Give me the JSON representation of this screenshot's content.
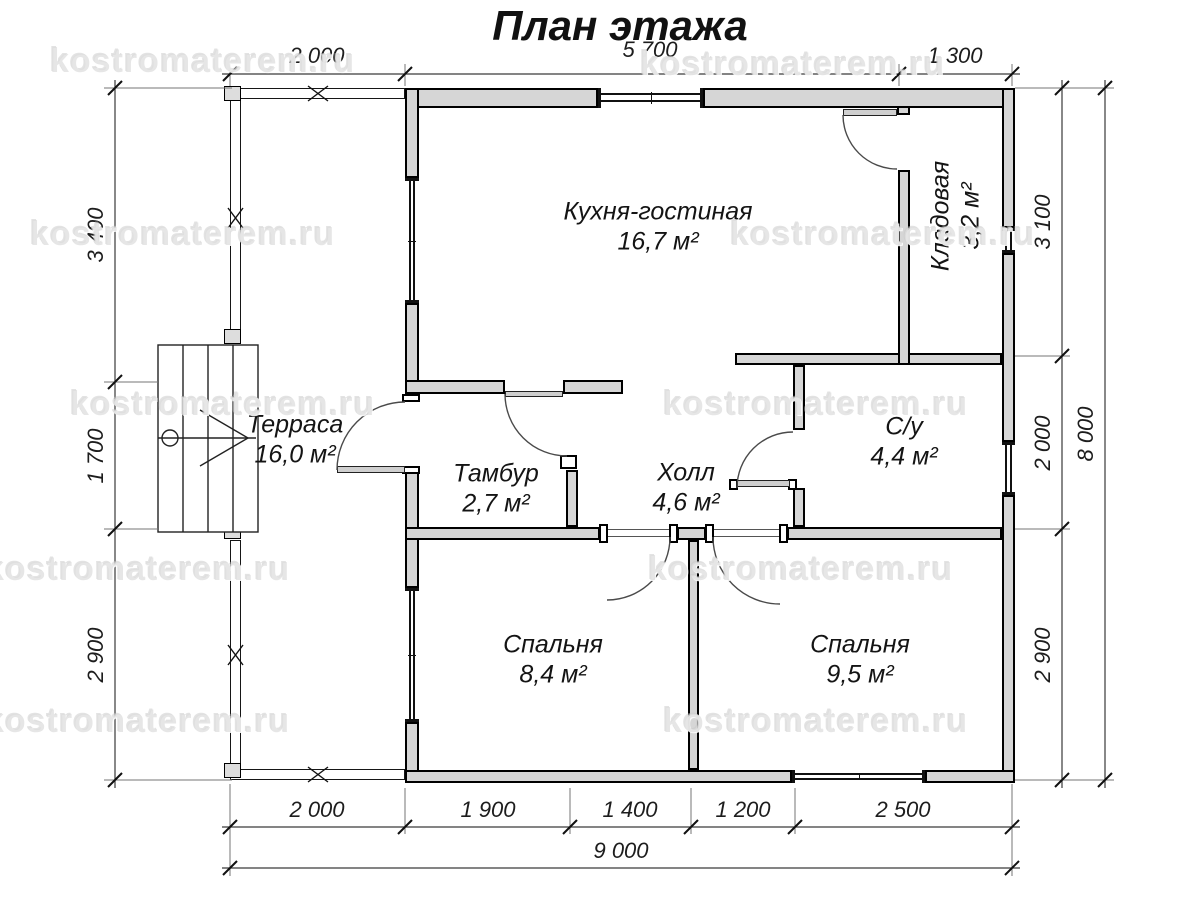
{
  "title": "План этажа",
  "watermark": "kostromaterem.ru",
  "rooms": {
    "kitchen": {
      "name": "Кухня-гостиная",
      "area": "16,7 м²"
    },
    "pantry": {
      "name": "Кладовая",
      "area": "3,2 м²"
    },
    "terrace": {
      "name": "Терраса",
      "area": "16,0 м²"
    },
    "vestibule": {
      "name": "Тамбур",
      "area": "2,7 м²"
    },
    "hall": {
      "name": "Холл",
      "area": "4,6 м²"
    },
    "bathroom": {
      "name": "С/у",
      "area": "4,4 м²"
    },
    "bedroom1": {
      "name": "Спальня",
      "area": "8,4 м²"
    },
    "bedroom2": {
      "name": "Спальня",
      "area": "9,5 м²"
    }
  },
  "dimensions": {
    "top": [
      "2 000",
      "5 700",
      "1 300"
    ],
    "left": [
      "3 400",
      "1 700",
      "2 900"
    ],
    "right": [
      "3 100",
      "2 000",
      "2 900"
    ],
    "right_total": "8 000",
    "bottom": [
      "2 000",
      "1 900",
      "1 400",
      "1 200",
      "2 500"
    ],
    "bottom_total": "9 000"
  },
  "colors": {
    "wall_fill": "#d6d6d6",
    "line": "#000000",
    "dimension": "#1d1d1d",
    "watermark": "#dddddd"
  }
}
